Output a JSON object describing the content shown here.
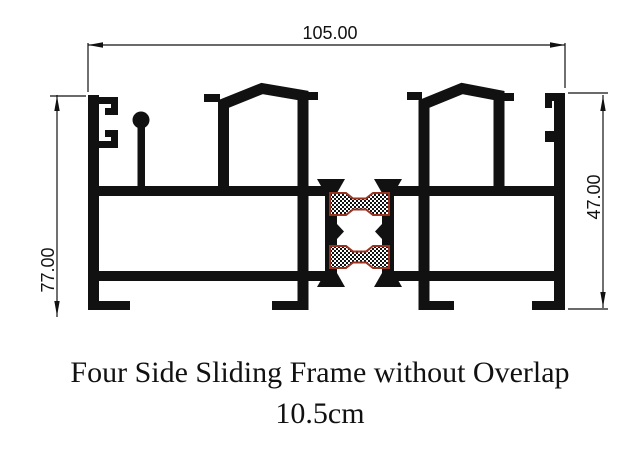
{
  "drawing": {
    "dim_top": "105.00",
    "dim_left": "77.00",
    "dim_right": "47.00"
  },
  "title": {
    "line1": "Four Side Sliding Frame without Overlap",
    "line2": "10.5cm"
  },
  "colors": {
    "background": "#ffffff",
    "ink": "#111111",
    "seal_outline": "#993322"
  }
}
